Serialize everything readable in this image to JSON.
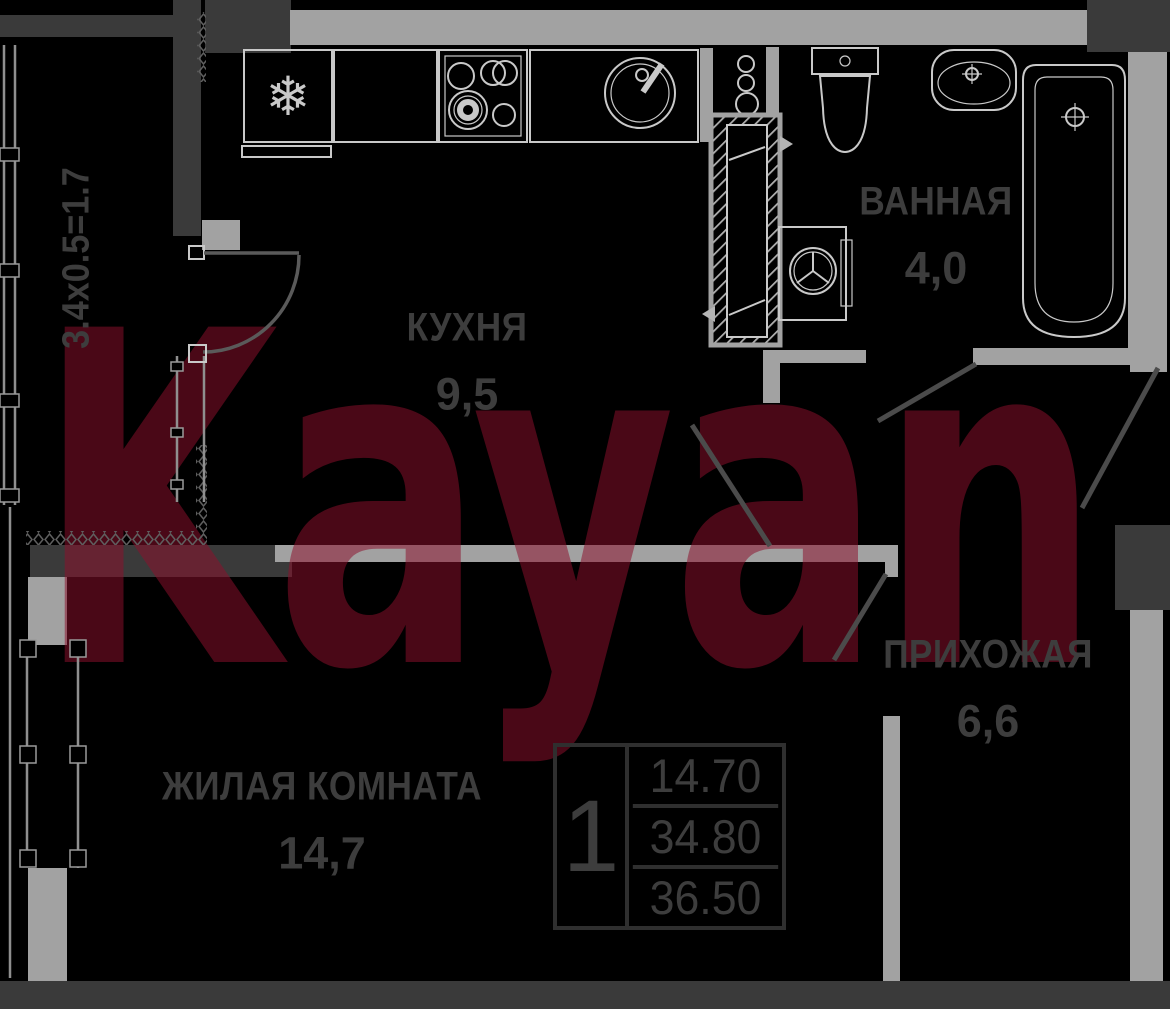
{
  "watermark_text": "Kayan",
  "balcony": {
    "dimension": "3.4x0.5=1.7"
  },
  "rooms": {
    "kitchen": {
      "name": "КУХНЯ",
      "area": "9,5"
    },
    "bathroom": {
      "name": "ВАННАЯ",
      "area": "4,0"
    },
    "hallway": {
      "name": "ПРИХОЖАЯ",
      "area": "6,6"
    },
    "living_room": {
      "name": "ЖИЛАЯ КОМНАТА",
      "area": "14,7"
    }
  },
  "info_table": {
    "rooms_count": "1",
    "values": [
      "14.70",
      "34.80",
      "36.50"
    ]
  },
  "icons": {
    "fridge_snowflake": "❄"
  },
  "colors": {
    "background": "#000000",
    "wall-dark": "#3a3a3a",
    "wall-light": "#a2a2a2",
    "fixture-line": "#c9c9c9",
    "door-line": "#4b4b4b",
    "label": "#3d3d3d",
    "table-line": "#2f2f2f",
    "watermark": "#8d102c"
  }
}
